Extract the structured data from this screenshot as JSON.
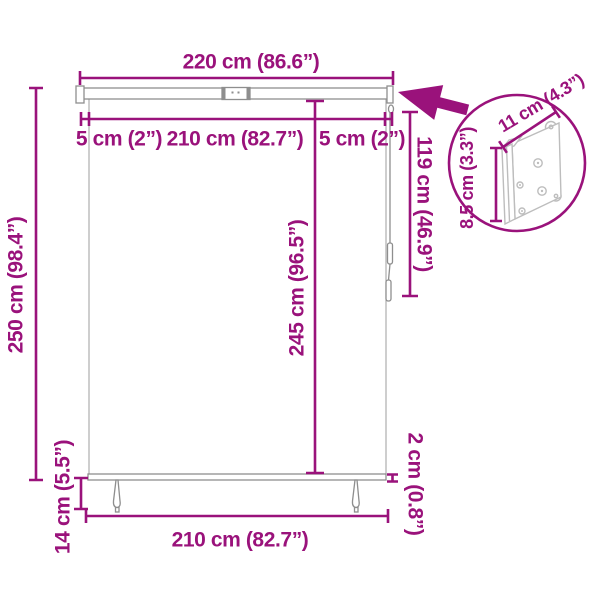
{
  "image_type": "product dimension diagram (outdoor roller blind / vertical awning)",
  "colors": {
    "accent_magenta": "#9A127B",
    "product_line_gray": "#8E8E8E",
    "bracket_gray": "#BDBDBD",
    "background": "#FFFFFF"
  },
  "labels": {
    "total_width": "220 cm (86.6”)",
    "left_inset": "5 cm (2”)",
    "inner_width": "210 cm (82.7”)",
    "right_inset": "5 cm (2”)",
    "total_height": "250 cm (98.4”)",
    "fabric_height": "245 cm (96.5”)",
    "cord_length": "119 cm (46.9”)",
    "bracket_width": "11 cm (4.3”)",
    "bracket_height": "8,5 cm (3.3”)",
    "foot_height": "14 cm (5.5”)",
    "bottom_width": "210 cm (82.7”)",
    "bar_thickness": "2 ccm"
  }
}
